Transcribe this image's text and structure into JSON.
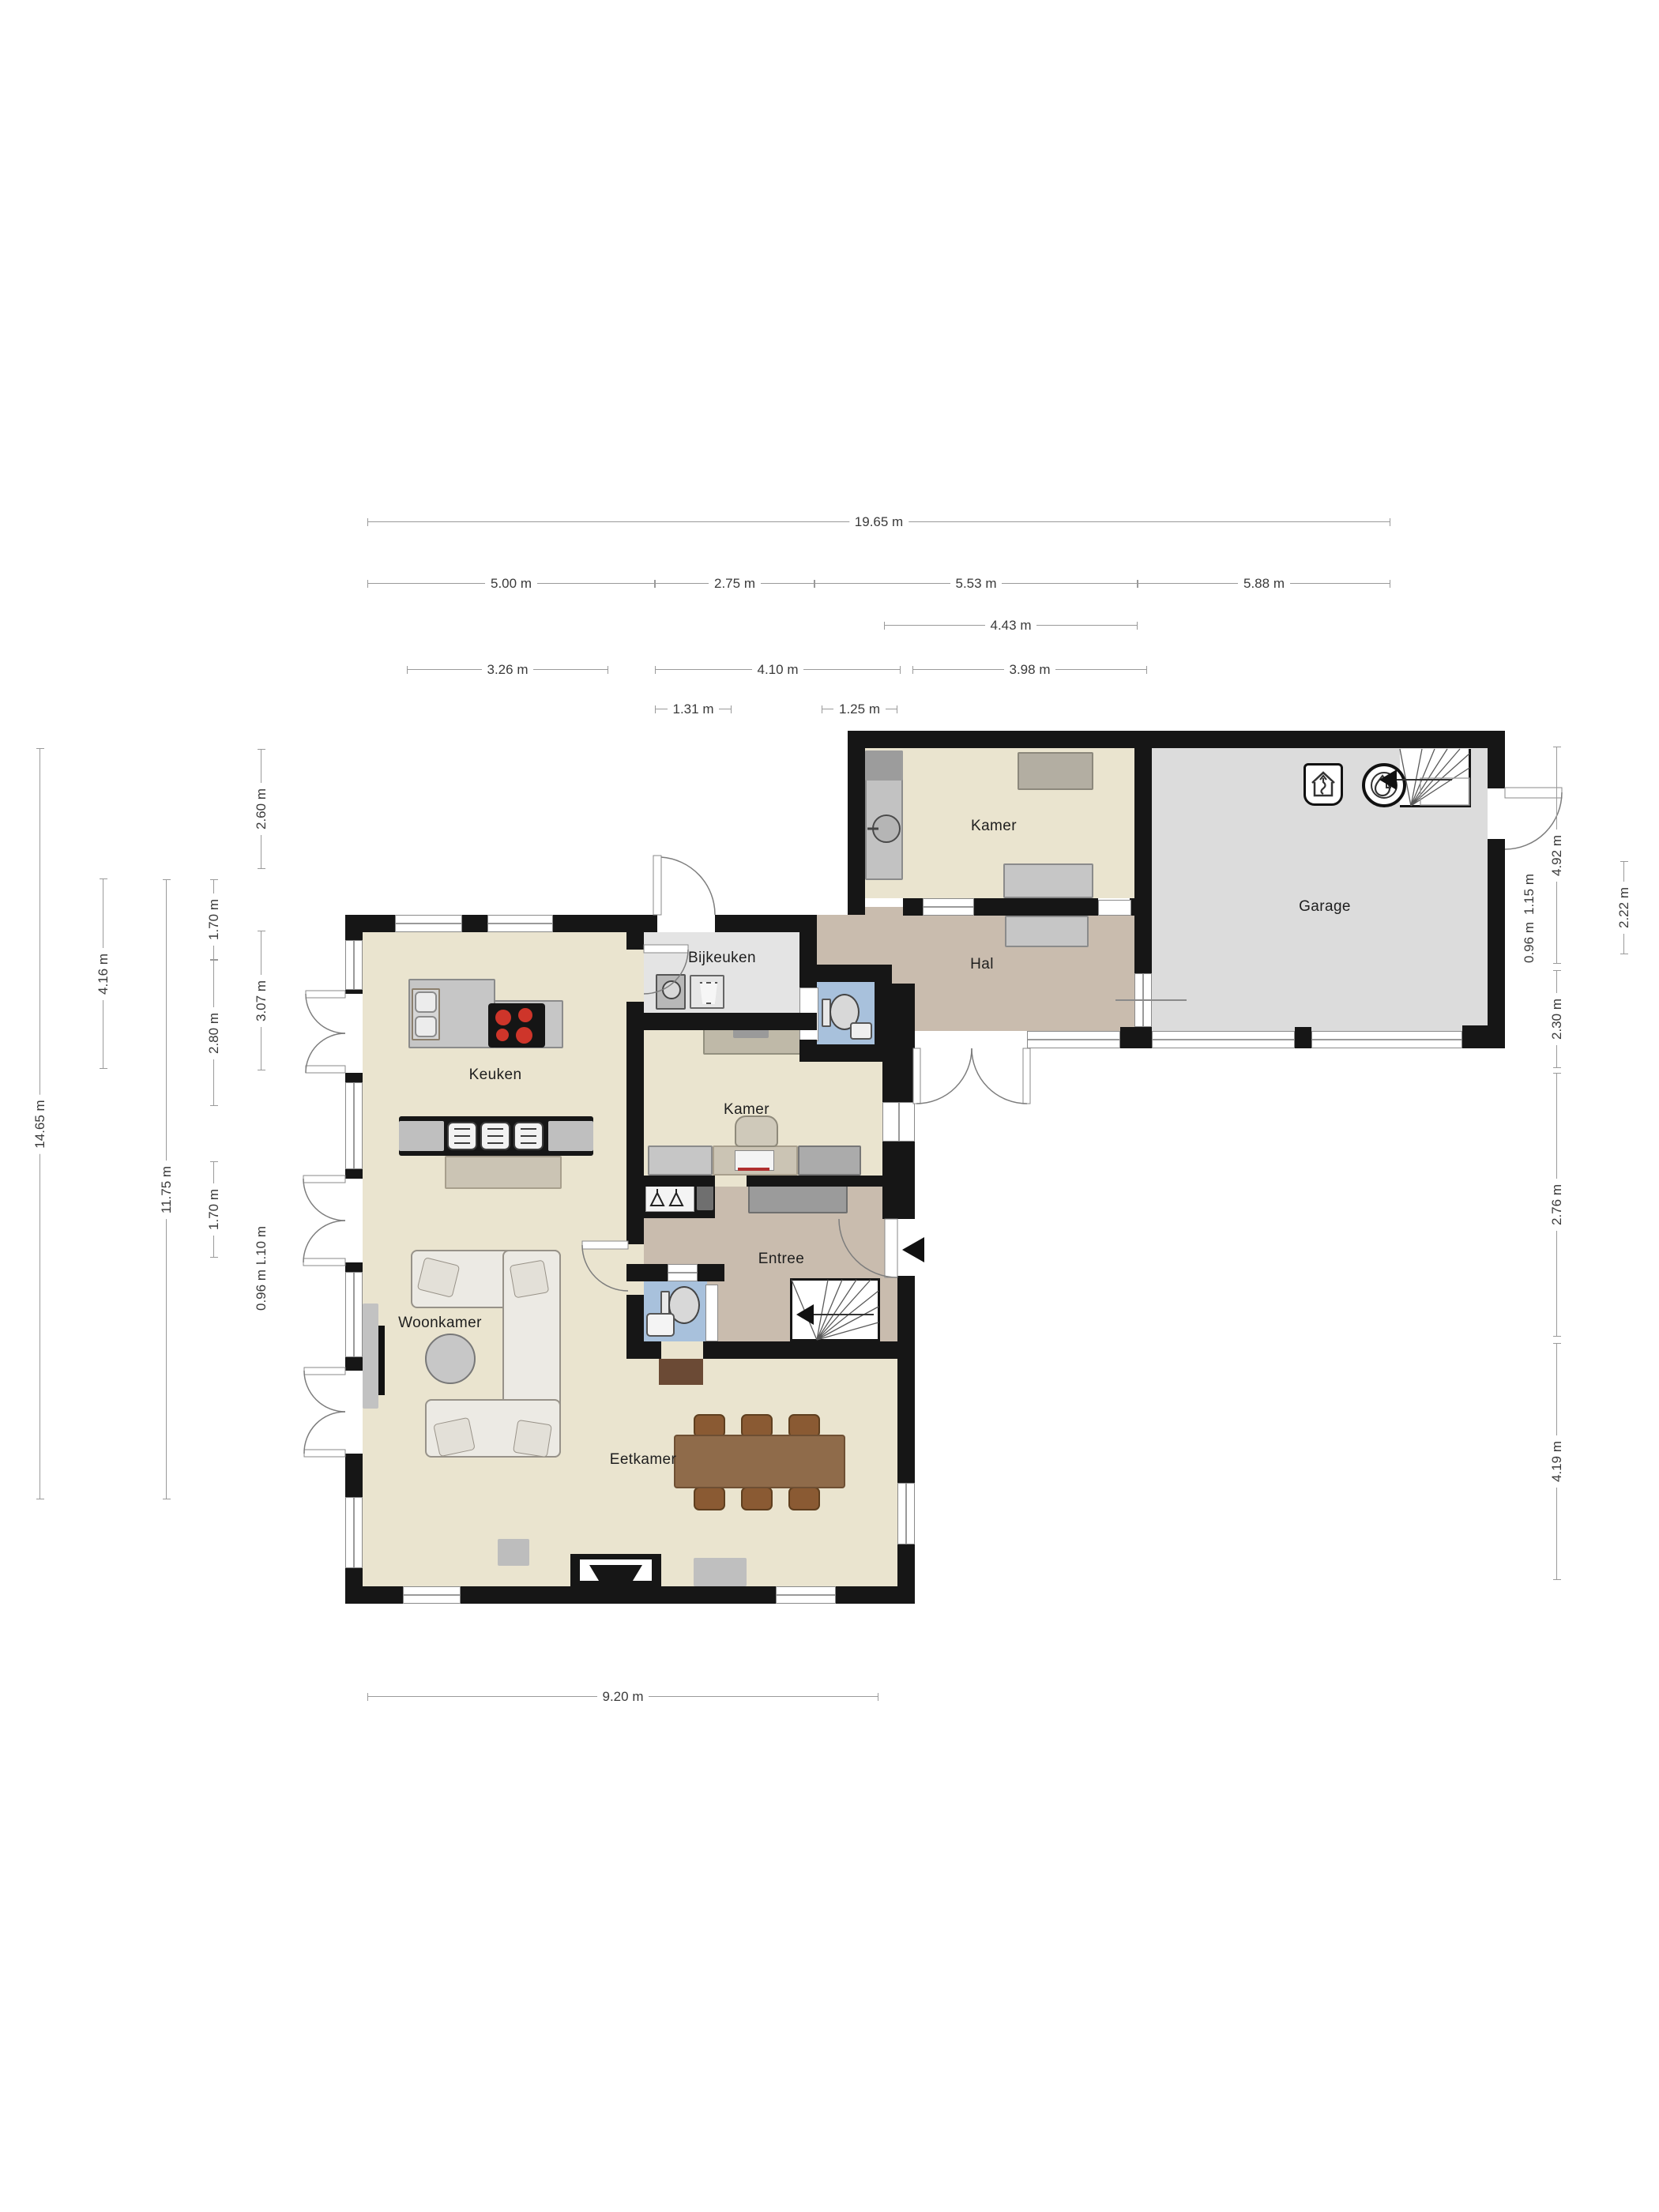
{
  "rooms": {
    "kamer_wing": {
      "label": "Kamer"
    },
    "garage": {
      "label": "Garage"
    },
    "bijkeuken": {
      "label": "Bijkeuken"
    },
    "hal": {
      "label": "Hal"
    },
    "keuken": {
      "label": "Keuken"
    },
    "kamer_mid": {
      "label": "Kamer"
    },
    "entree": {
      "label": "Entree"
    },
    "woonkamer": {
      "label": "Woonkamer"
    },
    "eetkamer": {
      "label": "Eetkamer"
    }
  },
  "dims": {
    "h": {
      "total": "19.65 m",
      "a": "5.00 m",
      "b": "2.75 m",
      "c": "5.53 m",
      "d": "5.88 m",
      "e": "4.43 m",
      "f": "3.26 m",
      "g": "4.10 m",
      "h": "3.98 m",
      "i": "1.31 m",
      "j": "1.25 m",
      "bottom": "9.20 m"
    },
    "l": {
      "total": "14.65 m",
      "a": "4.16 m",
      "b": "11.75 m",
      "c": "1.70 m",
      "d": "2.80 m",
      "e": "1.70 m",
      "f": "2.60 m",
      "g": "3.07 m",
      "h": "1.10 m",
      "i": "0.96 m"
    },
    "r": {
      "a": "4.92 m",
      "b": "1.15 m",
      "c": "0.96 m",
      "d": "2.22 m",
      "e": "2.30 m",
      "f": "2.76 m",
      "g": "4.19 m"
    }
  },
  "icons": {
    "ventilation_unit": "mechanical-ventilation-icon",
    "boiler": "central-heating-boiler-icon",
    "washing_machine": "washing-machine-icon",
    "laundry_basket": "laundry-basket-icon",
    "coat_hangers": "coat-hanger-icon",
    "entrance_marker": "entrance-arrow-icon",
    "stairs": "staircase-icon"
  },
  "colors": {
    "wall": "#161616",
    "floor_cream": "#EAE4CF",
    "floor_utility": "#E4E4E4",
    "floor_garage": "#DCDCDC",
    "floor_hall": "#C9BCAE",
    "floor_bath": "#A8C1DC",
    "burner_red": "#CE352A",
    "wood_table": "#8F6B4A",
    "wood_chair": "#8A5A33",
    "sofa": "#ECEAE4",
    "counter_gray": "#C6C6C6",
    "dim_line": "#9a9a9a"
  }
}
